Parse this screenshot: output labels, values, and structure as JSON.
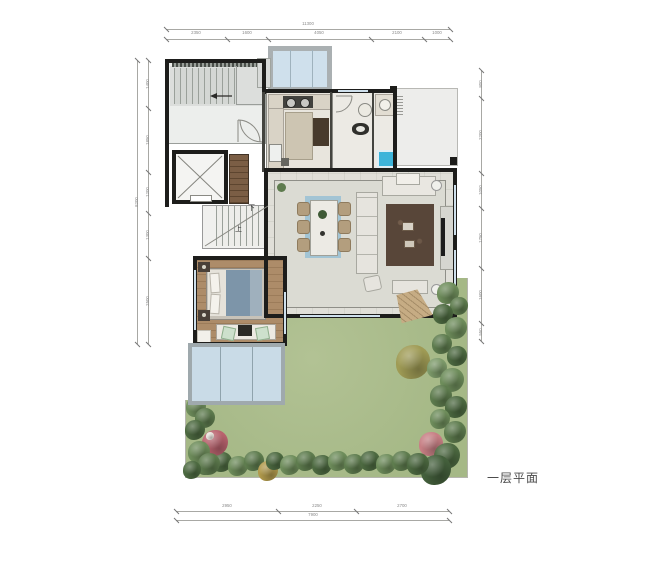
{
  "title": {
    "plan_label": "一层平面"
  },
  "labels": {
    "stairs_down": "下",
    "stairs_up": "上"
  },
  "colors": {
    "lawn": "#a9bc8b",
    "glass": "#cfe0ec",
    "courtyard_glass": "#c9dbe7",
    "wood_floor": "#ad8c69",
    "living_floor": "#dbdbd3",
    "wall": "#1d1d1b",
    "bed_blanket": "#7d95a9",
    "living_rug": "#584639",
    "dining_runner": "#a2c4d4",
    "shower": "#3db4da",
    "dimension_text": "#8a8a8a"
  },
  "dimensions": {
    "top": {
      "vertical": false,
      "lines": [
        {
          "x1": 166,
          "y1": 29,
          "x2": 450,
          "y2": 29
        },
        {
          "x1": 166,
          "y1": 39,
          "x2": 450,
          "y2": 39
        }
      ],
      "ticks": [
        {
          "x": 166,
          "y": 29
        },
        {
          "x": 450,
          "y": 29
        },
        {
          "x": 166,
          "y": 39
        },
        {
          "x": 227,
          "y": 39
        },
        {
          "x": 268,
          "y": 39
        },
        {
          "x": 371,
          "y": 39
        },
        {
          "x": 424,
          "y": 39
        },
        {
          "x": 450,
          "y": 39
        }
      ],
      "labels": [
        {
          "x": 308,
          "y": 24,
          "t": "11300"
        },
        {
          "x": 196,
          "y": 33,
          "t": "2350"
        },
        {
          "x": 247,
          "y": 33,
          "t": "1600"
        },
        {
          "x": 319,
          "y": 33,
          "t": "4050"
        },
        {
          "x": 397,
          "y": 33,
          "t": "2100"
        },
        {
          "x": 437,
          "y": 33,
          "t": "1000"
        }
      ]
    },
    "bottom": {
      "vertical": false,
      "lines": [
        {
          "x1": 176,
          "y1": 511,
          "x2": 449,
          "y2": 511
        },
        {
          "x1": 176,
          "y1": 520,
          "x2": 449,
          "y2": 520
        }
      ],
      "ticks": [
        {
          "x": 176,
          "y": 511
        },
        {
          "x": 278,
          "y": 511
        },
        {
          "x": 356,
          "y": 511
        },
        {
          "x": 449,
          "y": 511
        },
        {
          "x": 176,
          "y": 520
        },
        {
          "x": 449,
          "y": 520
        }
      ],
      "labels": [
        {
          "x": 227,
          "y": 506,
          "t": "2950"
        },
        {
          "x": 317,
          "y": 506,
          "t": "2250"
        },
        {
          "x": 402,
          "y": 506,
          "t": "2700"
        },
        {
          "x": 313,
          "y": 515,
          "t": "7900"
        }
      ]
    },
    "left": {
      "vertical": true,
      "lines": [
        {
          "x1": 137,
          "y1": 60,
          "x2": 137,
          "y2": 344
        },
        {
          "x1": 148,
          "y1": 60,
          "x2": 148,
          "y2": 344
        }
      ],
      "ticks": [
        {
          "x": 137,
          "y": 60
        },
        {
          "x": 137,
          "y": 344
        },
        {
          "x": 148,
          "y": 60
        },
        {
          "x": 148,
          "y": 108
        },
        {
          "x": 148,
          "y": 172
        },
        {
          "x": 148,
          "y": 213
        },
        {
          "x": 148,
          "y": 258
        },
        {
          "x": 148,
          "y": 344
        }
      ],
      "labels": [
        {
          "x": 137,
          "y": 202,
          "t": "8200"
        },
        {
          "x": 148,
          "y": 84,
          "t": "1400"
        },
        {
          "x": 148,
          "y": 140,
          "t": "1850"
        },
        {
          "x": 148,
          "y": 192,
          "t": "1200"
        },
        {
          "x": 148,
          "y": 235,
          "t": "1300"
        },
        {
          "x": 148,
          "y": 301,
          "t": "2500"
        }
      ]
    },
    "right": {
      "vertical": true,
      "lines": [
        {
          "x1": 481,
          "y1": 70,
          "x2": 481,
          "y2": 341
        }
      ],
      "ticks": [
        {
          "x": 481,
          "y": 70
        },
        {
          "x": 481,
          "y": 98
        },
        {
          "x": 481,
          "y": 173
        },
        {
          "x": 481,
          "y": 208
        },
        {
          "x": 481,
          "y": 268
        },
        {
          "x": 481,
          "y": 323
        },
        {
          "x": 481,
          "y": 341
        }
      ],
      "labels": [
        {
          "x": 481,
          "y": 84,
          "t": "800"
        },
        {
          "x": 481,
          "y": 135,
          "t": "2200"
        },
        {
          "x": 481,
          "y": 190,
          "t": "1050"
        },
        {
          "x": 481,
          "y": 238,
          "t": "1750"
        },
        {
          "x": 481,
          "y": 295,
          "t": "1600"
        },
        {
          "x": 481,
          "y": 332,
          "t": "550"
        }
      ]
    }
  },
  "garden": {
    "trees": [
      [
        448,
        293,
        11,
        "#6e8d5b"
      ],
      [
        459,
        306,
        9,
        "#5e7c4e"
      ],
      [
        443,
        314,
        10,
        "#4d6a41"
      ],
      [
        456,
        328,
        11,
        "#6e8d5b"
      ],
      [
        442,
        344,
        10,
        "#5e7c4e"
      ],
      [
        457,
        356,
        10,
        "#4d6a41"
      ],
      [
        413,
        362,
        17,
        "#9f9b55"
      ],
      [
        437,
        368,
        10,
        "#7d9a6a"
      ],
      [
        452,
        380,
        12,
        "#6e8d5b"
      ],
      [
        441,
        396,
        11,
        "#5e7c4e"
      ],
      [
        456,
        407,
        11,
        "#4d6a41"
      ],
      [
        440,
        419,
        10,
        "#6e8d5b"
      ],
      [
        455,
        432,
        11,
        "#5e7c4e"
      ],
      [
        431,
        444,
        12,
        "#c77f84"
      ],
      [
        447,
        456,
        13,
        "#4d6a41"
      ],
      [
        436,
        470,
        15,
        "#44603c"
      ],
      [
        206,
        465,
        10,
        "#5e7c4e"
      ],
      [
        222,
        462,
        10,
        "#4d6a41"
      ],
      [
        238,
        466,
        10,
        "#6e8d5b"
      ],
      [
        254,
        461,
        10,
        "#5e7c4e"
      ],
      [
        268,
        471,
        10,
        "#b19a4c"
      ],
      [
        275,
        461,
        9,
        "#4d6a41"
      ],
      [
        290,
        465,
        10,
        "#6e8d5b"
      ],
      [
        306,
        461,
        10,
        "#5e7c4e"
      ],
      [
        322,
        465,
        10,
        "#4d6a41"
      ],
      [
        338,
        461,
        10,
        "#6e8d5b"
      ],
      [
        354,
        464,
        10,
        "#5e7c4e"
      ],
      [
        370,
        461,
        10,
        "#4d6a41"
      ],
      [
        386,
        464,
        10,
        "#6e8d5b"
      ],
      [
        402,
        461,
        10,
        "#5e7c4e"
      ],
      [
        418,
        464,
        11,
        "#4d6a41"
      ],
      [
        196,
        407,
        10,
        "#6e8d5b"
      ],
      [
        205,
        418,
        10,
        "#5e7c4e"
      ],
      [
        195,
        430,
        10,
        "#4d6a41"
      ],
      [
        215,
        443,
        13,
        "#b9636e"
      ],
      [
        210,
        436,
        4,
        "#eae6de"
      ],
      [
        199,
        452,
        11,
        "#6e8d5b"
      ],
      [
        209,
        464,
        11,
        "#5e7c4e"
      ],
      [
        192,
        470,
        9,
        "#4d6a41"
      ]
    ]
  }
}
